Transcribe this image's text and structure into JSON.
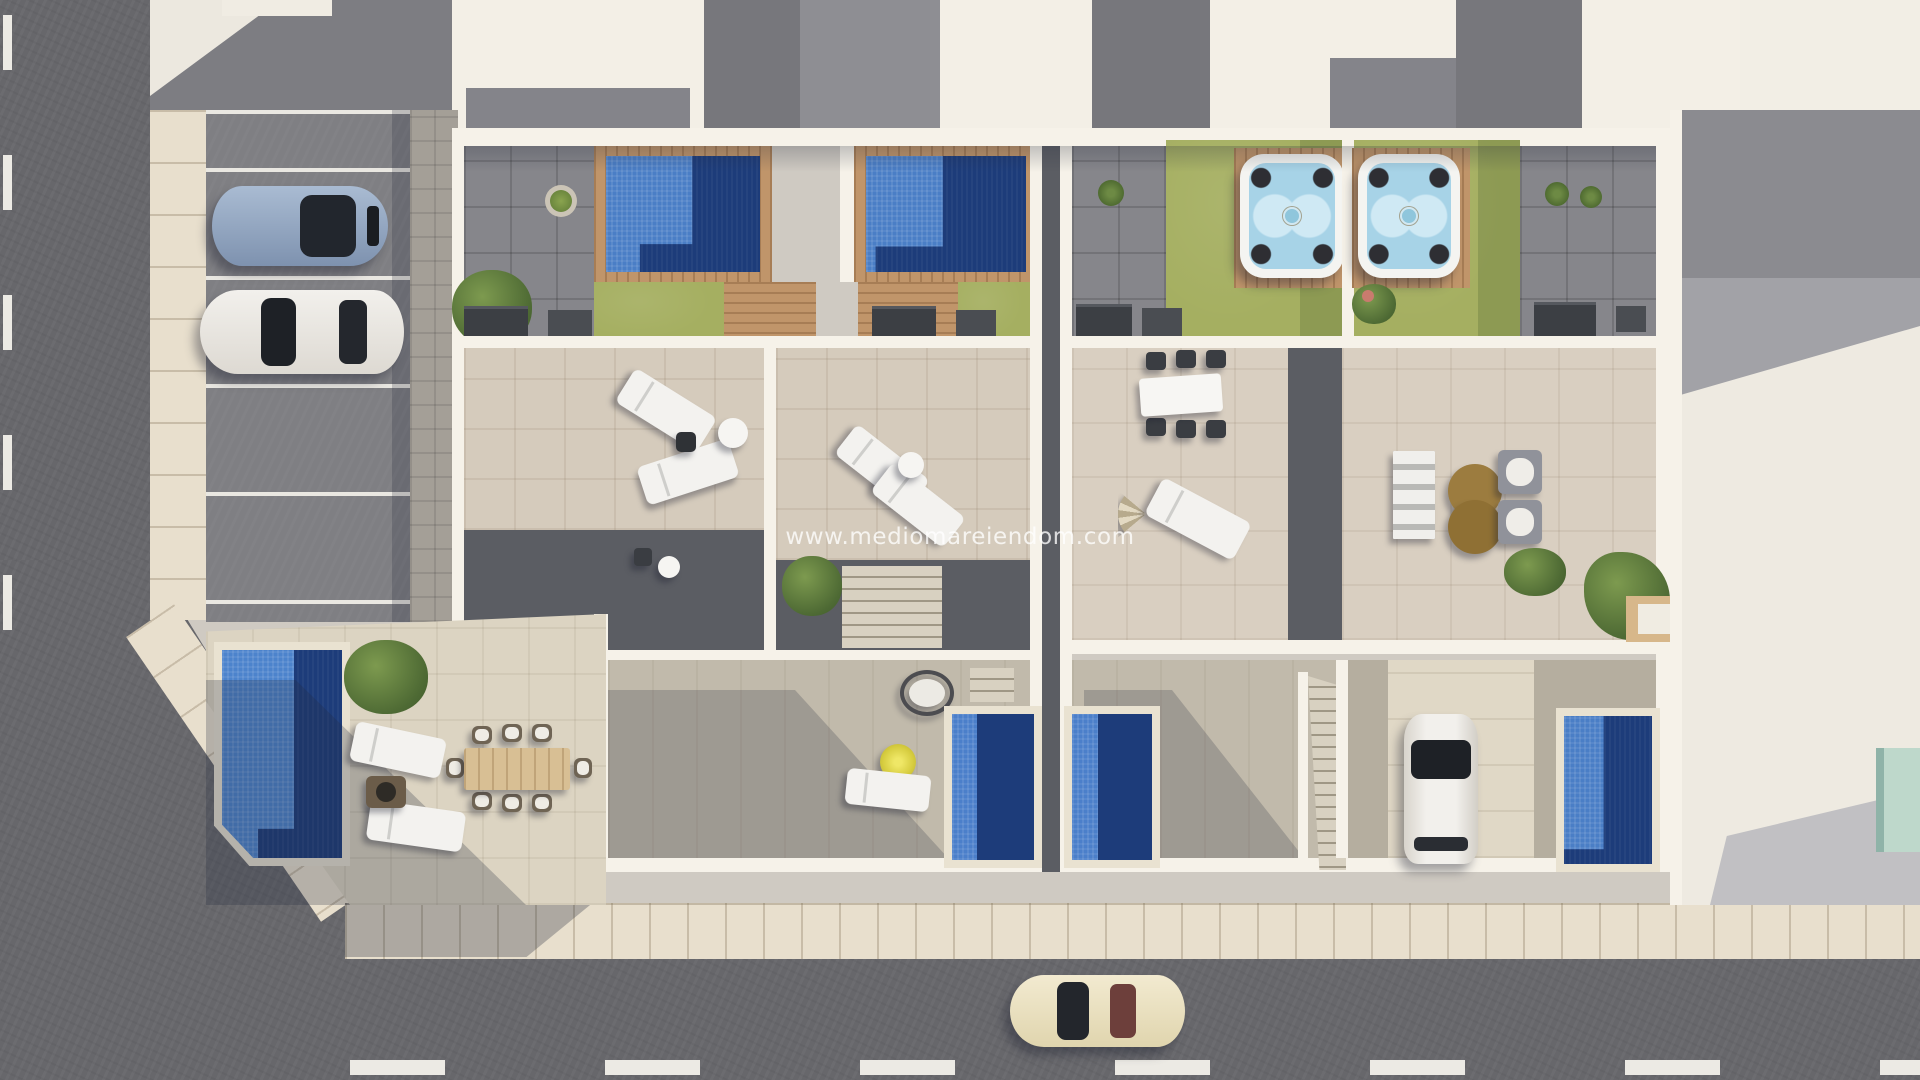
{
  "image_type": "aerial-3d-architectural-render",
  "description": "Top-down 3D render of four new-build townhouses with roof terraces, rooftop pools, hot tubs, lawns, backyard plunge pools, street parking, surrounding rooftops and two roads",
  "watermark": {
    "text": "www.mediomareiendom.com",
    "color": "#ffffff",
    "opacity": 0.78
  },
  "palette": {
    "asphalt": "#67676b",
    "parking_lot": "#7f7f83",
    "sidewalk": "#e8dfcd",
    "paver_strip": "#c9c1b2",
    "wall_white": "#f6f2e9",
    "terrace_tile": "#d5cbbc",
    "patio_gray": "#86868b",
    "lawn_green": "#a5af61",
    "pool_light_blue": "#4a7ec6",
    "pool_deep_navy": "#1d3c7a",
    "wood_deck": "#c0956a",
    "spa_water": "#a7d3e7",
    "teal_pool": "#bed8cb",
    "road_marking": "#eceae4",
    "car_blue": "#8aa0bd",
    "car_white": "#f0eeea",
    "car_cream": "#eae0bd",
    "shadow": "rgba(35,42,60,0.28)"
  },
  "scene": {
    "roads": [
      "left vertical street with dashed lane line",
      "bottom horizontal street with dashed lane line"
    ],
    "cars": [
      "blue car parked top-left",
      "white car parked top-left",
      "white car in right driveway",
      "cream car driving on bottom street"
    ],
    "pools": {
      "rooftop_pools": 2,
      "hot_tubs": 2,
      "backyard_pools": 4,
      "neighbor_teal_pool": 1
    },
    "furniture": [
      "sun loungers",
      "dining table with six chairs",
      "wicker dining set for eight",
      "lounge sofa set with round coffee table",
      "hanging egg chair",
      "yellow parasol",
      "fan parasol",
      "fire table"
    ]
  }
}
